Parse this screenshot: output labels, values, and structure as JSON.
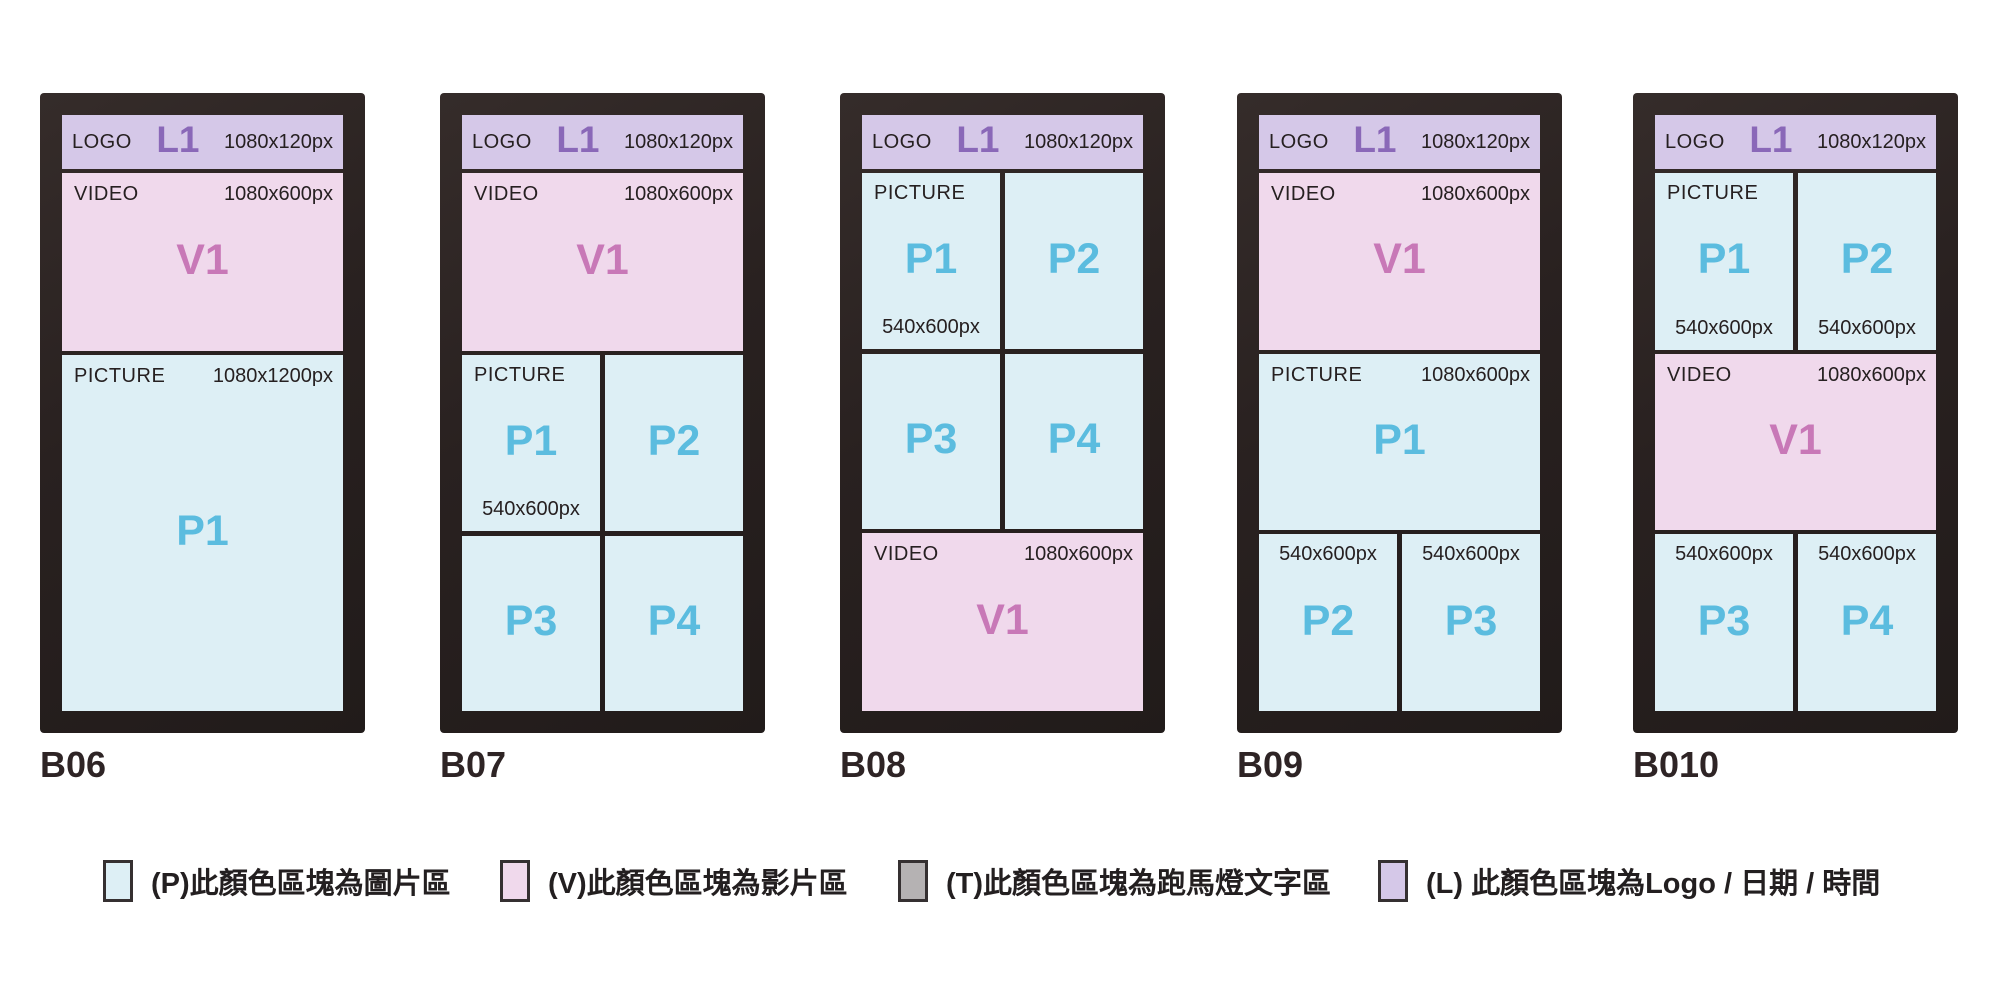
{
  "colors": {
    "picture_area": "#ddeff5",
    "video_area": "#f0d9ec",
    "logo_area": "#d5c8e8",
    "ticker_area": "#b5b2b3",
    "frame": "#292120",
    "picture_code": "#5bbcdf",
    "video_code": "#c878b7",
    "logo_code": "#8a68b8",
    "text_dark": "#262021"
  },
  "panels": [
    {
      "id": "B06",
      "logo": {
        "label": "LOGO",
        "code": "L1",
        "dim": "1080x120px"
      },
      "video": {
        "label": "VIDEO",
        "code": "V1",
        "dim": "1080x600px"
      },
      "picture": {
        "label": "PICTURE",
        "code": "P1",
        "dim": "1080x1200px"
      }
    },
    {
      "id": "B07",
      "logo": {
        "label": "LOGO",
        "code": "L1",
        "dim": "1080x120px"
      },
      "video": {
        "label": "VIDEO",
        "code": "V1",
        "dim": "1080x600px"
      },
      "grid": {
        "label": "PICTURE",
        "dim": "540x600px",
        "cells": [
          "P1",
          "P2",
          "P3",
          "P4"
        ]
      }
    },
    {
      "id": "B08",
      "logo": {
        "label": "LOGO",
        "code": "L1",
        "dim": "1080x120px"
      },
      "grid": {
        "label": "PICTURE",
        "dim": "540x600px",
        "cells": [
          "P1",
          "P2",
          "P3",
          "P4"
        ]
      },
      "video": {
        "label": "VIDEO",
        "code": "V1",
        "dim": "1080x600px"
      }
    },
    {
      "id": "B09",
      "logo": {
        "label": "LOGO",
        "code": "L1",
        "dim": "1080x120px"
      },
      "video": {
        "label": "VIDEO",
        "code": "V1",
        "dim": "1080x600px"
      },
      "picture": {
        "label": "PICTURE",
        "code": "P1",
        "dim": "1080x600px"
      },
      "bottom": {
        "cells": [
          {
            "code": "P2",
            "dim": "540x600px"
          },
          {
            "code": "P3",
            "dim": "540x600px"
          }
        ]
      }
    },
    {
      "id": "B010",
      "logo": {
        "label": "LOGO",
        "code": "L1",
        "dim": "1080x120px"
      },
      "top": {
        "label": "PICTURE",
        "cells": [
          {
            "code": "P1",
            "dim": "540x600px"
          },
          {
            "code": "P2",
            "dim": "540x600px"
          }
        ]
      },
      "video": {
        "label": "VIDEO",
        "code": "V1",
        "dim": "1080x600px"
      },
      "bottom": {
        "cells": [
          {
            "code": "P3",
            "dim": "540x600px"
          },
          {
            "code": "P4",
            "dim": "540x600px"
          }
        ]
      }
    }
  ],
  "legend": [
    {
      "key": "P",
      "text": "(P)此顏色區塊為圖片區"
    },
    {
      "key": "V",
      "text": "(V)此顏色區塊為影片區"
    },
    {
      "key": "T",
      "text": "(T)此顏色區塊為跑馬燈文字區"
    },
    {
      "key": "L",
      "text": "(L) 此顏色區塊為Logo / 日期 / 時間"
    }
  ]
}
